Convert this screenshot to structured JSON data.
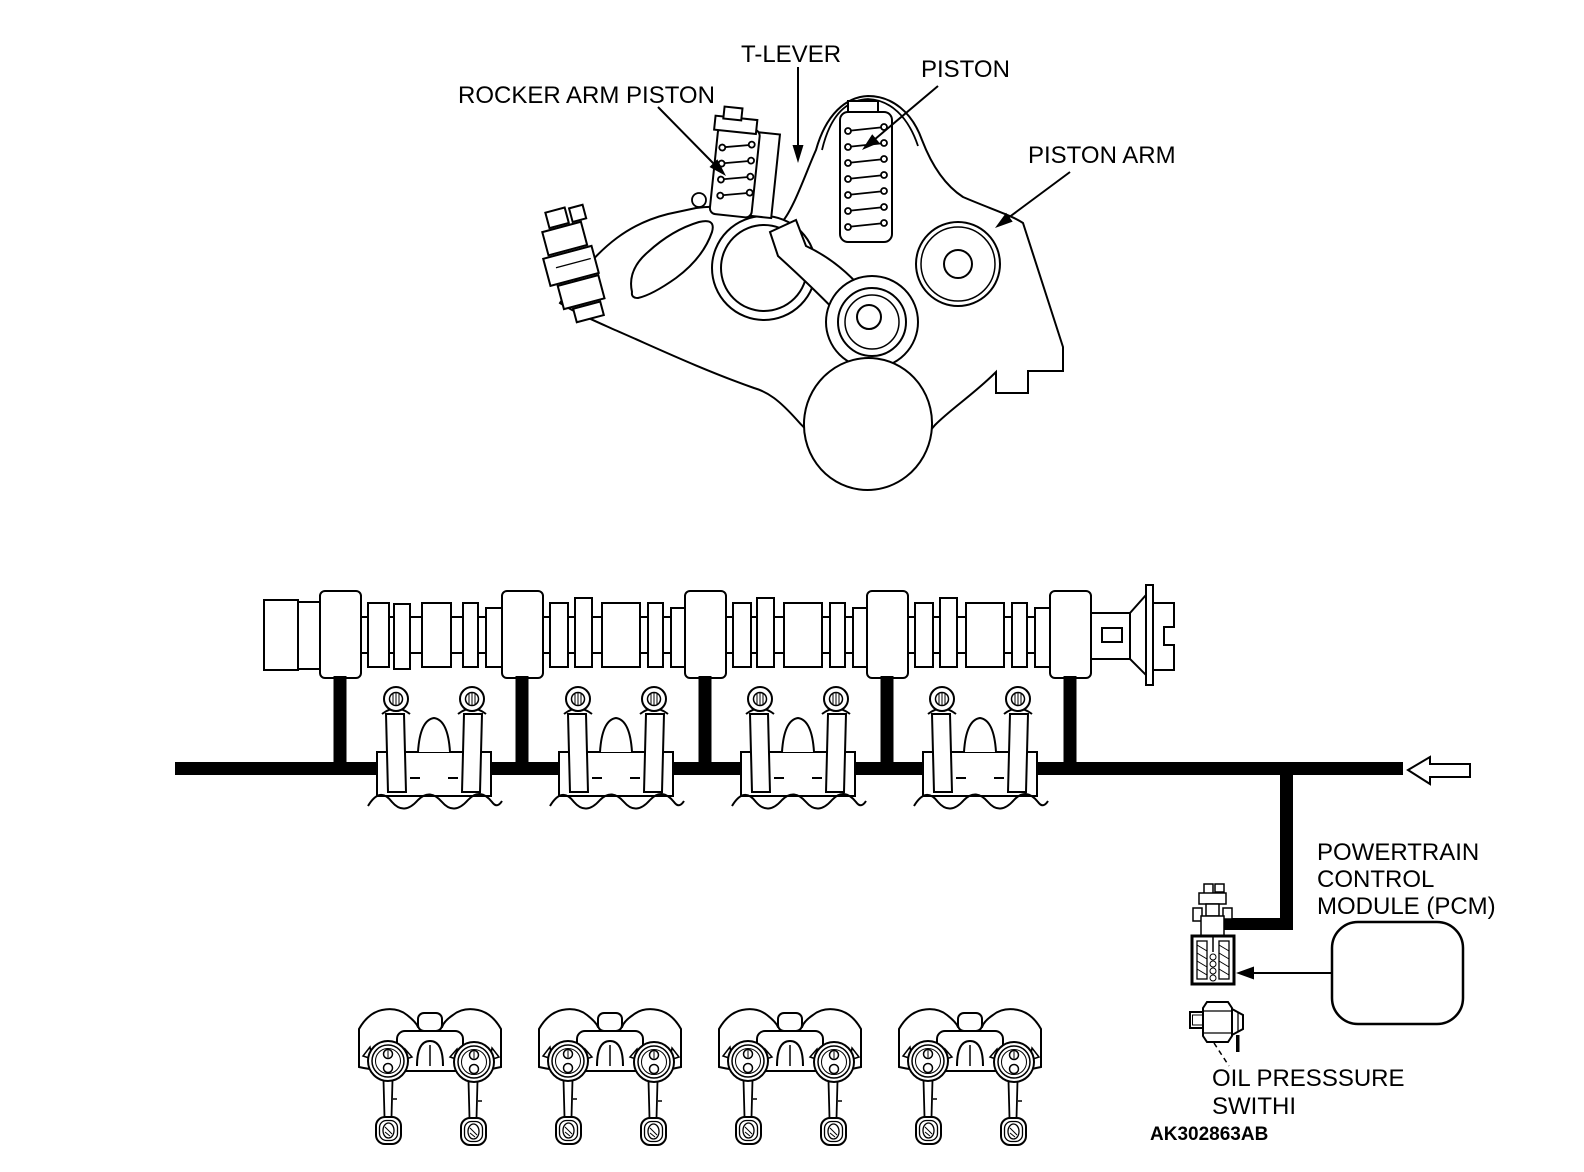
{
  "diagram": {
    "callouts": {
      "rocker_arm_piston": "ROCKER ARM PISTON",
      "t_lever": "T-LEVER",
      "piston": "PISTON",
      "piston_arm": "PISTON ARM"
    },
    "pcm": {
      "line1": "POWERTRAIN",
      "line2": "CONTROL",
      "line3": "MODULE (PCM)"
    },
    "oil_pressure_switch": {
      "line1": "OIL PRESSSURE",
      "line2": "SWITHI"
    },
    "figure_code": "AK302863AB"
  }
}
